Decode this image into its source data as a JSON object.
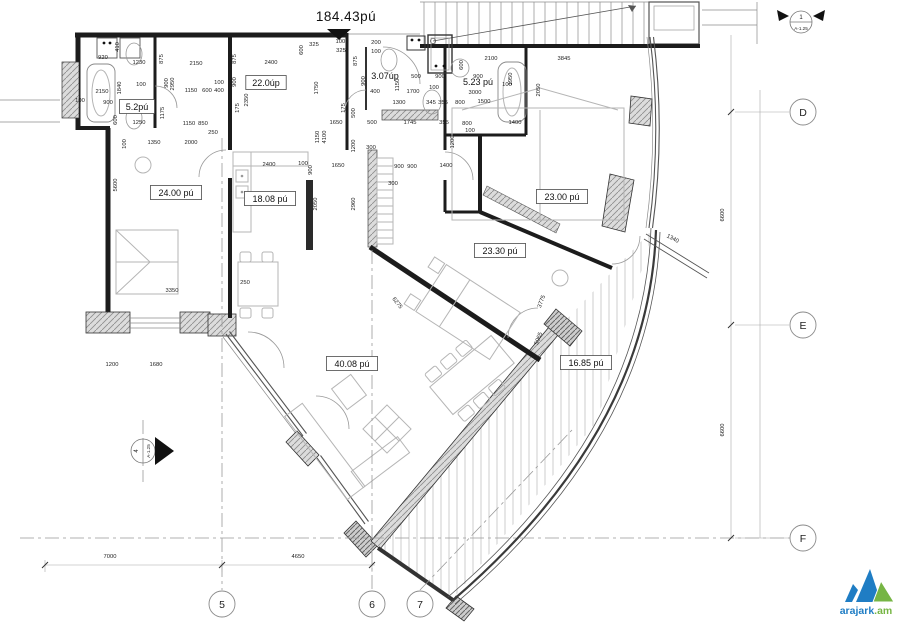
{
  "title": {
    "total_area": "184.43pú"
  },
  "rooms": [
    {
      "t": "5.2pú",
      "x": 137,
      "y": 107,
      "boxed": true
    },
    {
      "t": "22.0úp",
      "x": 266,
      "y": 83,
      "boxed": true
    },
    {
      "t": "3.07úp",
      "x": 385,
      "y": 76,
      "boxed": false
    },
    {
      "t": "5.23 pú",
      "x": 478,
      "y": 82,
      "boxed": false
    },
    {
      "t": "24.00 pú",
      "x": 176,
      "y": 193,
      "boxed": true
    },
    {
      "t": "18.08 pú",
      "x": 270,
      "y": 199,
      "boxed": true
    },
    {
      "t": "23.00 pú",
      "x": 562,
      "y": 197,
      "boxed": true
    },
    {
      "t": "23.30 pú",
      "x": 500,
      "y": 251,
      "boxed": true
    },
    {
      "t": "40.08 pú",
      "x": 352,
      "y": 364,
      "boxed": true
    },
    {
      "t": "16.85 pú",
      "x": 586,
      "y": 363,
      "boxed": true
    }
  ],
  "dimensions": [
    {
      "t": "920",
      "x": 103,
      "y": 59
    },
    {
      "t": "1230",
      "x": 139,
      "y": 64
    },
    {
      "t": "410",
      "x": 119,
      "y": 47,
      "r": -90
    },
    {
      "t": "2150",
      "x": 102,
      "y": 93
    },
    {
      "t": "1840",
      "x": 121,
      "y": 88,
      "r": -90
    },
    {
      "t": "900",
      "x": 108,
      "y": 104
    },
    {
      "t": "100",
      "x": 141,
      "y": 86
    },
    {
      "t": "600",
      "x": 117,
      "y": 120,
      "r": -90
    },
    {
      "t": "1250",
      "x": 139,
      "y": 124
    },
    {
      "t": "100",
      "x": 80,
      "y": 102
    },
    {
      "t": "875",
      "x": 163,
      "y": 59,
      "r": -90
    },
    {
      "t": "2150",
      "x": 196,
      "y": 65
    },
    {
      "t": "875",
      "x": 236,
      "y": 59,
      "r": -90
    },
    {
      "t": "2400",
      "x": 271,
      "y": 64
    },
    {
      "t": "900",
      "x": 168,
      "y": 83,
      "r": -90
    },
    {
      "t": "2950",
      "x": 174,
      "y": 84,
      "r": -90
    },
    {
      "t": "100",
      "x": 219,
      "y": 84
    },
    {
      "t": "1150",
      "x": 191,
      "y": 92
    },
    {
      "t": "600",
      "x": 207,
      "y": 92
    },
    {
      "t": "400",
      "x": 219,
      "y": 92
    },
    {
      "t": "900",
      "x": 236,
      "y": 82,
      "r": -90
    },
    {
      "t": "2350",
      "x": 248,
      "y": 100,
      "r": -90
    },
    {
      "t": "400",
      "x": 232,
      "y": 108,
      "r": -90
    },
    {
      "t": "175",
      "x": 239,
      "y": 108,
      "r": -90
    },
    {
      "t": "1175",
      "x": 164,
      "y": 113,
      "r": -90
    },
    {
      "t": "1150",
      "x": 189,
      "y": 125
    },
    {
      "t": "850",
      "x": 203,
      "y": 125
    },
    {
      "t": "250",
      "x": 213,
      "y": 134
    },
    {
      "t": "100",
      "x": 126,
      "y": 144,
      "r": -90
    },
    {
      "t": "1350",
      "x": 154,
      "y": 144
    },
    {
      "t": "2000",
      "x": 191,
      "y": 144
    },
    {
      "t": "5600",
      "x": 117,
      "y": 185,
      "r": -90
    },
    {
      "t": "3350",
      "x": 172,
      "y": 292
    },
    {
      "t": "1200",
      "x": 112,
      "y": 366
    },
    {
      "t": "1680",
      "x": 156,
      "y": 366
    },
    {
      "t": "325",
      "x": 314,
      "y": 46
    },
    {
      "t": "1000",
      "x": 342,
      "y": 43
    },
    {
      "t": "325",
      "x": 341,
      "y": 52
    },
    {
      "t": "600",
      "x": 303,
      "y": 50,
      "r": -90
    },
    {
      "t": "200",
      "x": 376,
      "y": 44
    },
    {
      "t": "100",
      "x": 376,
      "y": 53
    },
    {
      "t": "875",
      "x": 357,
      "y": 61,
      "r": -90
    },
    {
      "t": "900",
      "x": 365,
      "y": 81,
      "r": -90
    },
    {
      "t": "1750",
      "x": 318,
      "y": 88,
      "r": -90
    },
    {
      "t": "1150",
      "x": 399,
      "y": 85,
      "r": -90
    },
    {
      "t": "400",
      "x": 375,
      "y": 93
    },
    {
      "t": "1700",
      "x": 413,
      "y": 93
    },
    {
      "t": "100",
      "x": 434,
      "y": 89
    },
    {
      "t": "500",
      "x": 416,
      "y": 78
    },
    {
      "t": "900",
      "x": 440,
      "y": 78
    },
    {
      "t": "1300",
      "x": 399,
      "y": 104
    },
    {
      "t": "345",
      "x": 431,
      "y": 104
    },
    {
      "t": "355",
      "x": 443,
      "y": 104
    },
    {
      "t": "800",
      "x": 460,
      "y": 104
    },
    {
      "t": "1500",
      "x": 484,
      "y": 103
    },
    {
      "t": "3000",
      "x": 475,
      "y": 94
    },
    {
      "t": "175",
      "x": 345,
      "y": 108,
      "r": -90
    },
    {
      "t": "500",
      "x": 355,
      "y": 113,
      "r": -90
    },
    {
      "t": "1650",
      "x": 336,
      "y": 124
    },
    {
      "t": "500",
      "x": 372,
      "y": 124
    },
    {
      "t": "1745",
      "x": 410,
      "y": 124
    },
    {
      "t": "355",
      "x": 444,
      "y": 124
    },
    {
      "t": "800",
      "x": 467,
      "y": 125
    },
    {
      "t": "100",
      "x": 470,
      "y": 132
    },
    {
      "t": "1150",
      "x": 319,
      "y": 137,
      "r": -90
    },
    {
      "t": "4100",
      "x": 326,
      "y": 137,
      "r": -90
    },
    {
      "t": "1200",
      "x": 355,
      "y": 146,
      "r": -90
    },
    {
      "t": "300",
      "x": 371,
      "y": 149
    },
    {
      "t": "1200",
      "x": 454,
      "y": 142,
      "r": -90
    },
    {
      "t": "900",
      "x": 312,
      "y": 170,
      "r": -90
    },
    {
      "t": "1650",
      "x": 338,
      "y": 167
    },
    {
      "t": "900",
      "x": 399,
      "y": 168
    },
    {
      "t": "900",
      "x": 412,
      "y": 168
    },
    {
      "t": "1400",
      "x": 446,
      "y": 167
    },
    {
      "t": "300",
      "x": 393,
      "y": 185
    },
    {
      "t": "2100",
      "x": 491,
      "y": 60
    },
    {
      "t": "3845",
      "x": 564,
      "y": 60
    },
    {
      "t": "600",
      "x": 463,
      "y": 65,
      "r": -90
    },
    {
      "t": "900",
      "x": 478,
      "y": 78
    },
    {
      "t": "1950",
      "x": 512,
      "y": 79,
      "r": -90
    },
    {
      "t": "100",
      "x": 507,
      "y": 86
    },
    {
      "t": "2050",
      "x": 540,
      "y": 90,
      "r": -90
    },
    {
      "t": "1400",
      "x": 515,
      "y": 124
    },
    {
      "t": "2400",
      "x": 269,
      "y": 166
    },
    {
      "t": "100",
      "x": 303,
      "y": 165
    },
    {
      "t": "2050",
      "x": 317,
      "y": 204,
      "r": -90
    },
    {
      "t": "2960",
      "x": 355,
      "y": 204,
      "r": -90
    },
    {
      "t": "250",
      "x": 245,
      "y": 284
    },
    {
      "t": "6275",
      "x": 396,
      "y": 304,
      "r": 52
    },
    {
      "t": "3775",
      "x": 543,
      "y": 302,
      "r": -70
    },
    {
      "t": "5065",
      "x": 540,
      "y": 339,
      "r": -70
    },
    {
      "t": "1340",
      "x": 672,
      "y": 240,
      "r": 28
    },
    {
      "t": "6600",
      "x": 724,
      "y": 215,
      "r": -90,
      "s": 8.5
    },
    {
      "t": "6600",
      "x": 724,
      "y": 430,
      "r": -90,
      "s": 8.5
    },
    {
      "t": "7000",
      "x": 110,
      "y": 558,
      "s": 8.5
    },
    {
      "t": "4650",
      "x": 298,
      "y": 558,
      "s": 8.5
    }
  ],
  "grid": {
    "right": [
      {
        "label": "D",
        "x": 803,
        "y": 112
      },
      {
        "label": "E",
        "x": 803,
        "y": 325
      },
      {
        "label": "F",
        "x": 803,
        "y": 538
      }
    ],
    "bottom": [
      {
        "label": "5",
        "x": 222,
        "y": 604
      },
      {
        "label": "6",
        "x": 372,
        "y": 604
      },
      {
        "label": "7",
        "x": 420,
        "y": 604
      }
    ]
  },
  "section_markers": {
    "top_right": {
      "number": "1",
      "sheet": "A-1.25"
    },
    "left": {
      "number": "4",
      "sheet": "A-1.25"
    }
  },
  "logo": {
    "text_primary": "arajark",
    "text_suffix": ".am",
    "blue": "#1f7dc4",
    "green": "#76b544"
  }
}
